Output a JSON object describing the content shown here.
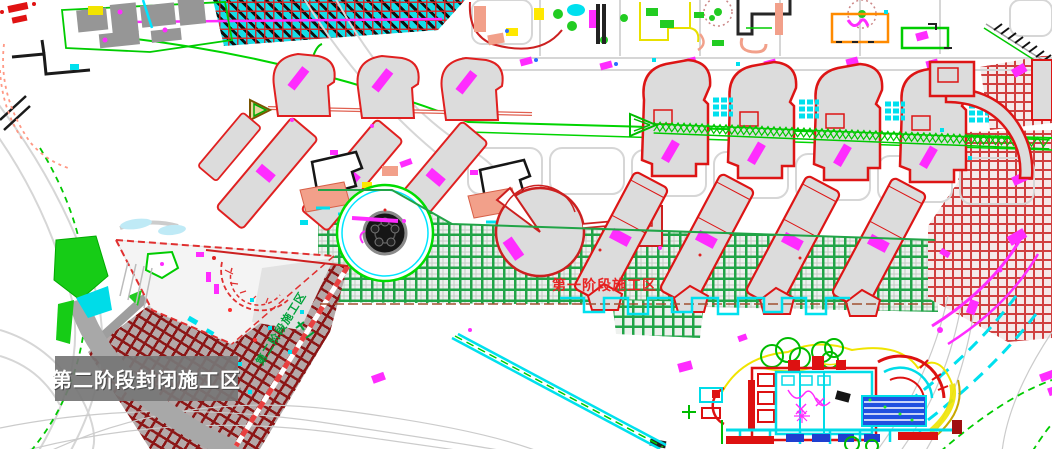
{
  "labels": {
    "phase2_closed_overlay": "第二阶段封闭施工区",
    "phase1_zone": "第一阶段施工区",
    "phase2_zone_small": "第二阶段施工区"
  },
  "zones": [
    {
      "id": "phase1",
      "label": "第一阶段施工区",
      "hatch_color": "#21a447",
      "label_color": "#e82424"
    },
    {
      "id": "phase2-closed",
      "label": "第二阶段封闭施工区",
      "hatch_color": "#8c1616",
      "label_color": "#ffffff"
    }
  ],
  "colors": {
    "background": "#ffffff",
    "road": "#d6d6d6",
    "green-line": "#00d400",
    "building-outline": "#dd1515",
    "building-fill": "#dcdcdc",
    "hatch-green": "#21a447",
    "hatch-dark-red": "#8c1616",
    "magenta": "#ff2cff",
    "cyan": "#00e0ee",
    "yellow": "#ffe800",
    "overlay-bg": "#767676",
    "overlay-text": "#ffffff"
  }
}
